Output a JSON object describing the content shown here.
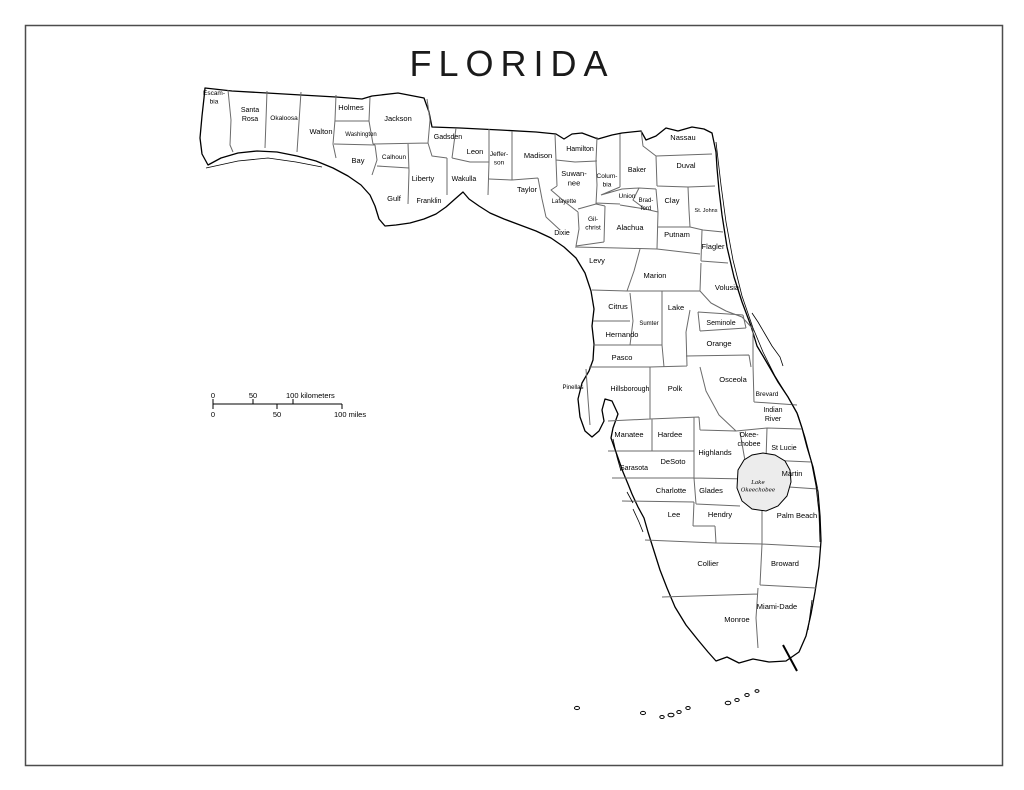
{
  "title": "FLORIDA",
  "colors": {
    "background": "#ffffff",
    "frame": "#4d4d4d",
    "coast_line": "#000000",
    "county_line": "#6b6b6b",
    "lake_fill": "#ececec"
  },
  "scale_bar": {
    "line": {
      "x1": 213,
      "x2": 342,
      "y": 404
    },
    "km_ticks": [
      213,
      253,
      293
    ],
    "mile_ticks": [
      213,
      277,
      342
    ],
    "km_label_y": 398,
    "mile_label_y": 417,
    "km_labels": [
      {
        "t": "0",
        "x": 213,
        "anchor": "middle"
      },
      {
        "t": "50",
        "x": 253,
        "anchor": "middle"
      },
      {
        "t": "100 kilometers",
        "x": 286,
        "anchor": "start"
      }
    ],
    "mile_labels": [
      {
        "t": "0",
        "x": 213,
        "anchor": "middle"
      },
      {
        "t": "50",
        "x": 277,
        "anchor": "middle"
      },
      {
        "t": "100 miles",
        "x": 334,
        "anchor": "start"
      }
    ]
  },
  "lake": {
    "lines": [
      "Lake",
      "Okeechobee"
    ],
    "x": 758,
    "y": 484,
    "size": 5.5
  },
  "counties": [
    {
      "name": "Escambia",
      "lines": [
        "Escam-",
        "bia"
      ],
      "x": 214,
      "y": 95,
      "size": 6.5
    },
    {
      "name": "Santa Rosa",
      "lines": [
        "Santa",
        "Rosa"
      ],
      "x": 250,
      "y": 112,
      "size": 7
    },
    {
      "name": "Okaloosa",
      "lines": [
        "Okaloosa"
      ],
      "x": 284,
      "y": 120,
      "size": 6.5
    },
    {
      "name": "Walton",
      "lines": [
        "Walton"
      ],
      "x": 321,
      "y": 134,
      "size": 7.5
    },
    {
      "name": "Holmes",
      "lines": [
        "Holmes"
      ],
      "x": 351,
      "y": 110,
      "size": 7.5
    },
    {
      "name": "Washington",
      "lines": [
        "Washington"
      ],
      "x": 361,
      "y": 136,
      "size": 6
    },
    {
      "name": "Jackson",
      "lines": [
        "Jackson"
      ],
      "x": 398,
      "y": 121,
      "size": 7.5
    },
    {
      "name": "Bay",
      "lines": [
        "Bay"
      ],
      "x": 358,
      "y": 163,
      "size": 7.5
    },
    {
      "name": "Calhoun",
      "lines": [
        "Calhoun"
      ],
      "x": 394,
      "y": 159,
      "size": 6.5
    },
    {
      "name": "Gadsden",
      "lines": [
        "Gadsden"
      ],
      "x": 448,
      "y": 139,
      "size": 7
    },
    {
      "name": "Leon",
      "lines": [
        "Leon"
      ],
      "x": 475,
      "y": 154,
      "size": 7.5
    },
    {
      "name": "Jefferson",
      "lines": [
        "Jeffer-",
        "son"
      ],
      "x": 499,
      "y": 156,
      "size": 6.5
    },
    {
      "name": "Madison",
      "lines": [
        "Madison"
      ],
      "x": 538,
      "y": 158,
      "size": 7.5
    },
    {
      "name": "Hamilton",
      "lines": [
        "Hamilton"
      ],
      "x": 580,
      "y": 151,
      "size": 7
    },
    {
      "name": "Suwannee",
      "lines": [
        "Suwan-",
        "nee"
      ],
      "x": 574,
      "y": 176,
      "size": 7.5
    },
    {
      "name": "Columbia",
      "lines": [
        "Colum-",
        "bia"
      ],
      "x": 607,
      "y": 178,
      "size": 6.5
    },
    {
      "name": "Baker",
      "lines": [
        "Baker"
      ],
      "x": 637,
      "y": 172,
      "size": 7
    },
    {
      "name": "Nassau",
      "lines": [
        "Nassau"
      ],
      "x": 683,
      "y": 140,
      "size": 7.5
    },
    {
      "name": "Duval",
      "lines": [
        "Duval"
      ],
      "x": 686,
      "y": 168,
      "size": 7.5
    },
    {
      "name": "Liberty",
      "lines": [
        "Liberty"
      ],
      "x": 423,
      "y": 181,
      "size": 7.5
    },
    {
      "name": "Wakulla",
      "lines": [
        "Wakulla"
      ],
      "x": 464,
      "y": 181,
      "size": 7
    },
    {
      "name": "Gulf",
      "lines": [
        "Gulf"
      ],
      "x": 394,
      "y": 201,
      "size": 7.5
    },
    {
      "name": "Franklin",
      "lines": [
        "Franklin"
      ],
      "x": 429,
      "y": 203,
      "size": 7
    },
    {
      "name": "Taylor",
      "lines": [
        "Taylor"
      ],
      "x": 527,
      "y": 192,
      "size": 7.5
    },
    {
      "name": "Lafayette",
      "lines": [
        "Lafayette"
      ],
      "x": 564,
      "y": 203,
      "size": 6
    },
    {
      "name": "Union",
      "lines": [
        "Union"
      ],
      "x": 627,
      "y": 198,
      "size": 6.5
    },
    {
      "name": "Bradford",
      "lines": [
        "Brad-",
        "ford"
      ],
      "x": 646,
      "y": 202,
      "size": 6
    },
    {
      "name": "Clay",
      "lines": [
        "Clay"
      ],
      "x": 672,
      "y": 203,
      "size": 7.5
    },
    {
      "name": "St. Johns",
      "lines": [
        "St. Johns"
      ],
      "x": 706,
      "y": 212,
      "size": 5.5
    },
    {
      "name": "Dixie",
      "lines": [
        "Dixie"
      ],
      "x": 562,
      "y": 235,
      "size": 7
    },
    {
      "name": "Gilchrist",
      "lines": [
        "Gil-",
        "christ"
      ],
      "x": 593,
      "y": 221,
      "size": 6.5
    },
    {
      "name": "Alachua",
      "lines": [
        "Alachua"
      ],
      "x": 630,
      "y": 230,
      "size": 7.5
    },
    {
      "name": "Putnam",
      "lines": [
        "Putnam"
      ],
      "x": 677,
      "y": 237,
      "size": 7.5
    },
    {
      "name": "Flagler",
      "lines": [
        "Flagler"
      ],
      "x": 713,
      "y": 249,
      "size": 7.5
    },
    {
      "name": "Levy",
      "lines": [
        "Levy"
      ],
      "x": 597,
      "y": 263,
      "size": 7.5
    },
    {
      "name": "Marion",
      "lines": [
        "Marion"
      ],
      "x": 655,
      "y": 278,
      "size": 7.5
    },
    {
      "name": "Volusia",
      "lines": [
        "Volusia"
      ],
      "x": 727,
      "y": 290,
      "size": 7.5
    },
    {
      "name": "Citrus",
      "lines": [
        "Citrus"
      ],
      "x": 618,
      "y": 309,
      "size": 7.5
    },
    {
      "name": "Lake",
      "lines": [
        "Lake"
      ],
      "x": 676,
      "y": 310,
      "size": 7.5
    },
    {
      "name": "Sumter",
      "lines": [
        "Sumter"
      ],
      "x": 649,
      "y": 325,
      "size": 6
    },
    {
      "name": "Seminole",
      "lines": [
        "Seminole"
      ],
      "x": 721,
      "y": 325,
      "size": 7
    },
    {
      "name": "Hernando",
      "lines": [
        "Hernando"
      ],
      "x": 622,
      "y": 337,
      "size": 7.5
    },
    {
      "name": "Orange",
      "lines": [
        "Orange"
      ],
      "x": 719,
      "y": 346,
      "size": 7.5
    },
    {
      "name": "Pasco",
      "lines": [
        "Pasco"
      ],
      "x": 622,
      "y": 360,
      "size": 7.5
    },
    {
      "name": "Osceola",
      "lines": [
        "Osceola"
      ],
      "x": 733,
      "y": 382,
      "size": 7.5
    },
    {
      "name": "Pinellas",
      "lines": [
        "Pinellas"
      ],
      "x": 573,
      "y": 389,
      "size": 6
    },
    {
      "name": "Hillsborough",
      "lines": [
        "Hillsborough"
      ],
      "x": 630,
      "y": 391,
      "size": 7
    },
    {
      "name": "Polk",
      "lines": [
        "Polk"
      ],
      "x": 675,
      "y": 391,
      "size": 7.5
    },
    {
      "name": "Brevard",
      "lines": [
        "Brevard"
      ],
      "x": 767,
      "y": 396,
      "size": 6.5
    },
    {
      "name": "Indian River",
      "lines": [
        "Indian",
        "River"
      ],
      "x": 773,
      "y": 412,
      "size": 7
    },
    {
      "name": "Manatee",
      "lines": [
        "Manatee"
      ],
      "x": 629,
      "y": 437,
      "size": 7.5
    },
    {
      "name": "Hardee",
      "lines": [
        "Hardee"
      ],
      "x": 670,
      "y": 437,
      "size": 7.5
    },
    {
      "name": "Okeechobee",
      "lines": [
        "Okee-",
        "chobee"
      ],
      "x": 749,
      "y": 437,
      "size": 7
    },
    {
      "name": "St Lucie",
      "lines": [
        "St Lucie"
      ],
      "x": 784,
      "y": 450,
      "size": 7
    },
    {
      "name": "Sarasota",
      "lines": [
        "Sarasota"
      ],
      "x": 634,
      "y": 470,
      "size": 7
    },
    {
      "name": "DeSoto",
      "lines": [
        "DeSoto"
      ],
      "x": 673,
      "y": 464,
      "size": 7.5
    },
    {
      "name": "Highlands",
      "lines": [
        "Highlands"
      ],
      "x": 715,
      "y": 455,
      "size": 7.5
    },
    {
      "name": "Martin",
      "lines": [
        "Martin"
      ],
      "x": 792,
      "y": 476,
      "size": 7.5
    },
    {
      "name": "Charlotte",
      "lines": [
        "Charlotte"
      ],
      "x": 671,
      "y": 493,
      "size": 7.5
    },
    {
      "name": "Glades",
      "lines": [
        "Glades"
      ],
      "x": 711,
      "y": 493,
      "size": 7.5
    },
    {
      "name": "Lee",
      "lines": [
        "Lee"
      ],
      "x": 674,
      "y": 517,
      "size": 7.5
    },
    {
      "name": "Hendry",
      "lines": [
        "Hendry"
      ],
      "x": 720,
      "y": 517,
      "size": 7.5
    },
    {
      "name": "Palm Beach",
      "lines": [
        "Palm Beach"
      ],
      "x": 797,
      "y": 518,
      "size": 7.5
    },
    {
      "name": "Collier",
      "lines": [
        "Collier"
      ],
      "x": 708,
      "y": 566,
      "size": 7.5
    },
    {
      "name": "Broward",
      "lines": [
        "Broward"
      ],
      "x": 785,
      "y": 566,
      "size": 7.5
    },
    {
      "name": "Miami-Dade",
      "lines": [
        "Miami-Dade"
      ],
      "x": 777,
      "y": 609,
      "size": 7.5
    },
    {
      "name": "Monroe",
      "lines": [
        "Monroe"
      ],
      "x": 737,
      "y": 622,
      "size": 7.5
    }
  ]
}
